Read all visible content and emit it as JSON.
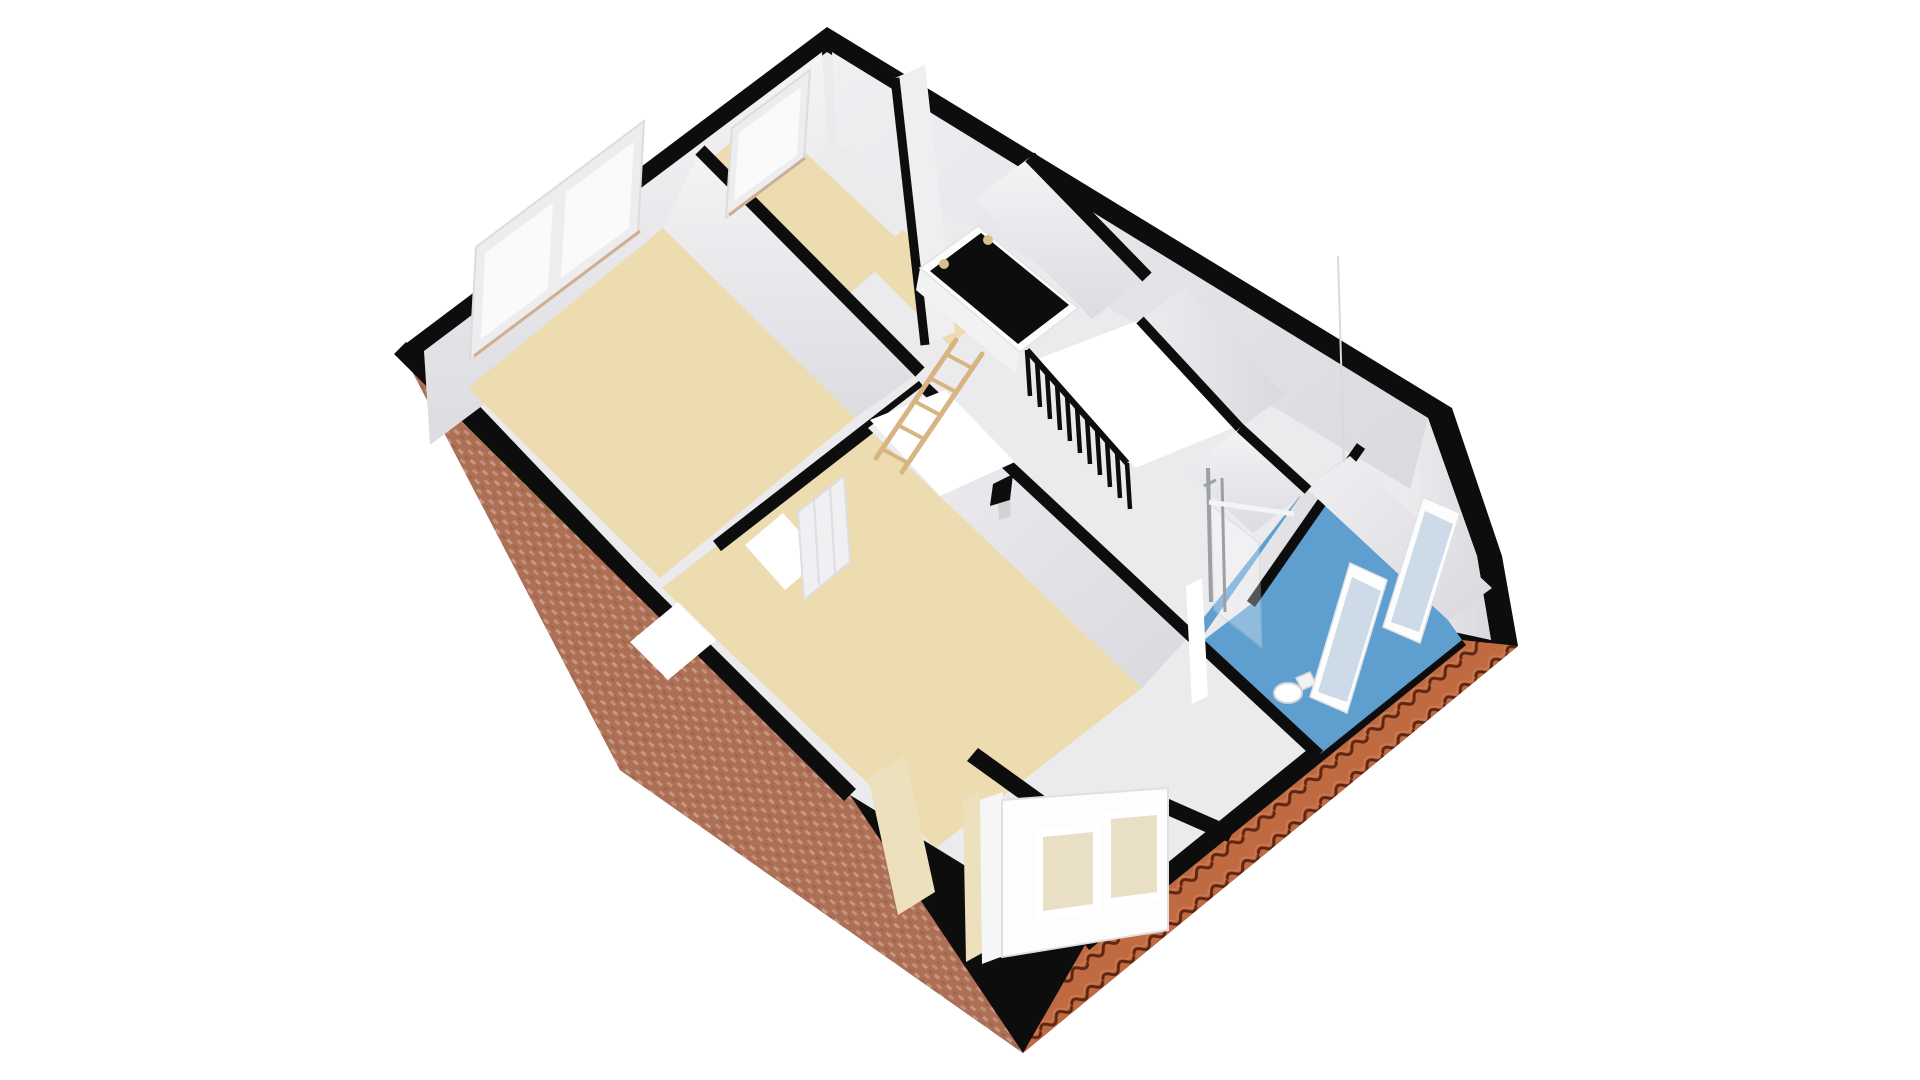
{
  "figure": {
    "kind": "3d-floor-plan",
    "view": "isometric dollhouse cutaway",
    "level": "attic floor",
    "background": "#ffffff"
  },
  "palette": {
    "outline_black": "#0d0d0d",
    "wall_light": "#ebebee",
    "wall_bright": "#f1f1f3",
    "wall_mid": "#e4e4e8",
    "wall_shadow": "#d7d7dc",
    "floor_beige": "#ecdcb0",
    "bathroom_blue": "#5f9fd0",
    "brick_base": "#ad6f55",
    "brick_dot": "#cfa68d",
    "tile_base": "#c06a42",
    "tile_groove": "#5f2612",
    "wood": "#d8b483",
    "cream_dormer": "#ede0bd",
    "glass_white": "#fafafa",
    "glass_roof": "#ccdbe7",
    "glass_dormer": "#e9dfc4",
    "chrome": "#9aa0a6",
    "void_white": "#ffffff",
    "hatch_light": "#d8c08a"
  },
  "rooms": [
    {
      "id": "bedroom-left",
      "floor_finish": "beige",
      "window_count": 2
    },
    {
      "id": "room-top",
      "floor_finish": "beige",
      "window_count": 1
    },
    {
      "id": "landing",
      "floor_finish": "beige",
      "features": [
        "loft-hatch",
        "folding-ladder",
        "stair-opening",
        "railing"
      ]
    },
    {
      "id": "bedroom-bottom",
      "floor_finish": "beige",
      "features": [
        "dormer-window",
        "door-opening"
      ]
    },
    {
      "id": "bathroom",
      "floor_finish": "blue",
      "features": [
        "walk-in-shower",
        "toilet",
        "roof-windows"
      ]
    }
  ],
  "fixtures": {
    "railing_balusters": 11,
    "ladder_rungs": 5,
    "roof_windows": 2,
    "dormer_window_panes": 2,
    "hatch_spotlights": 2
  },
  "exterior": {
    "front_facade": "brick",
    "side_roof": "terracotta tiles",
    "wall_caps": "black"
  }
}
